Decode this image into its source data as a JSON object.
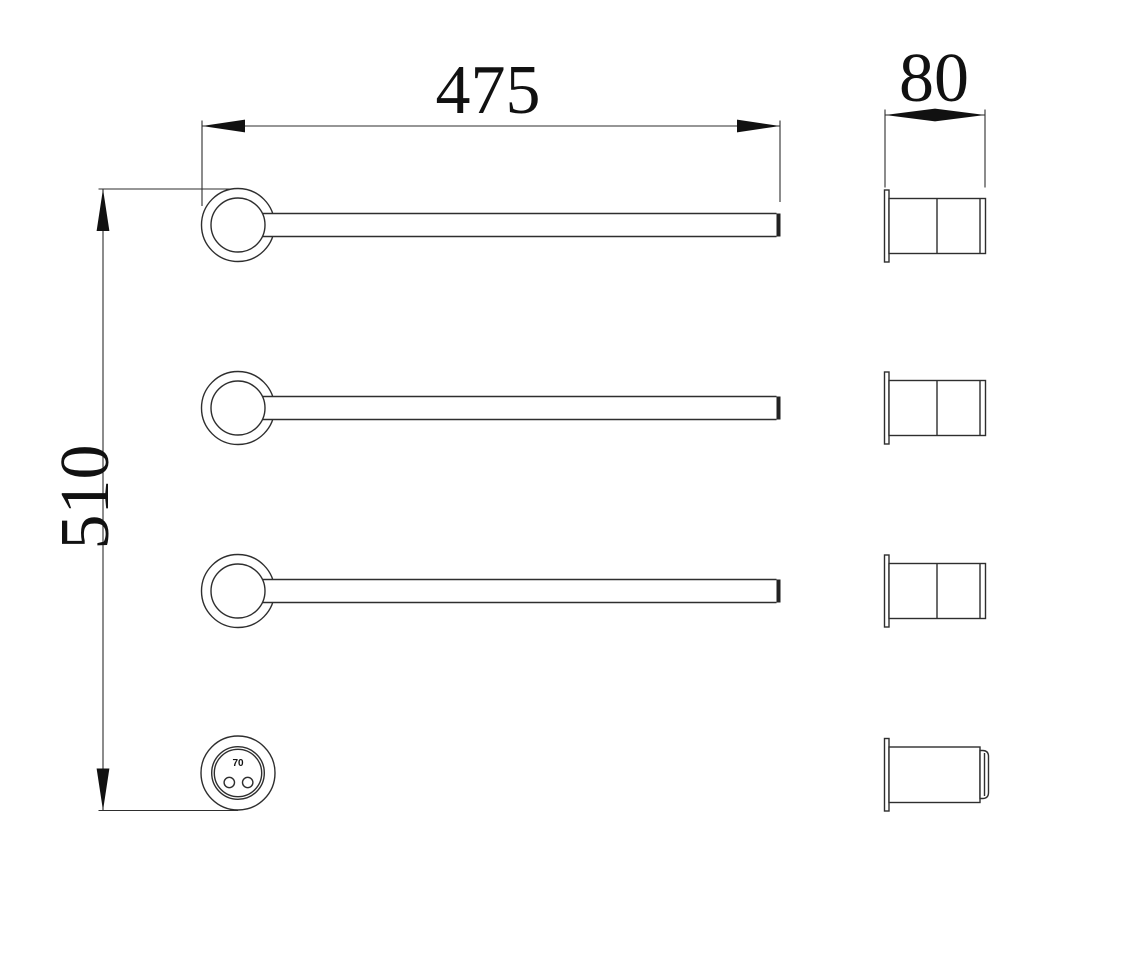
{
  "drawing": {
    "background_color": "#ffffff",
    "line_color": "#2e2e2e",
    "arrow_color": "#111111",
    "dimensions": {
      "width": {
        "value": "475",
        "orientation": "horizontal-top"
      },
      "height": {
        "value": "510",
        "orientation": "vertical-left"
      },
      "depth": {
        "value": "80",
        "orientation": "horizontal-top-right"
      },
      "connector_diameter": {
        "value": "70"
      }
    },
    "front_view": {
      "towel_bars": 3,
      "power_connector_holes": 2
    },
    "side_view": {
      "wall_mounts": 4
    }
  }
}
